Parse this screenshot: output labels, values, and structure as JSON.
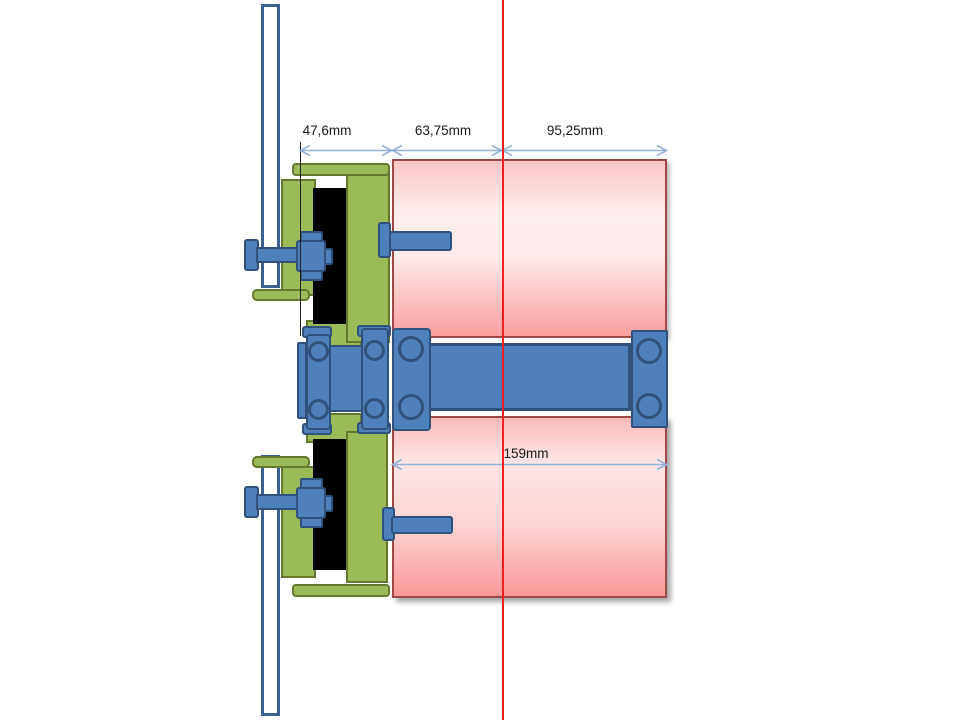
{
  "annotations": {
    "dim_47": "47,6mm",
    "dim_63": "63,75mm",
    "dim_95": "95,25mm",
    "dim_159": "159mm"
  },
  "colors": {
    "accent_blue": "#4e81bc",
    "accent_blue_dark": "#2f517c",
    "green": "#9bbb59",
    "green_dark": "#66782e",
    "pink_border": "#a04848",
    "red_centerline": "#f02020",
    "dim_line": "#95b3d7",
    "panel_border": "#3b5f8e",
    "black_part": "#000000",
    "text": "#1a1a1a"
  }
}
